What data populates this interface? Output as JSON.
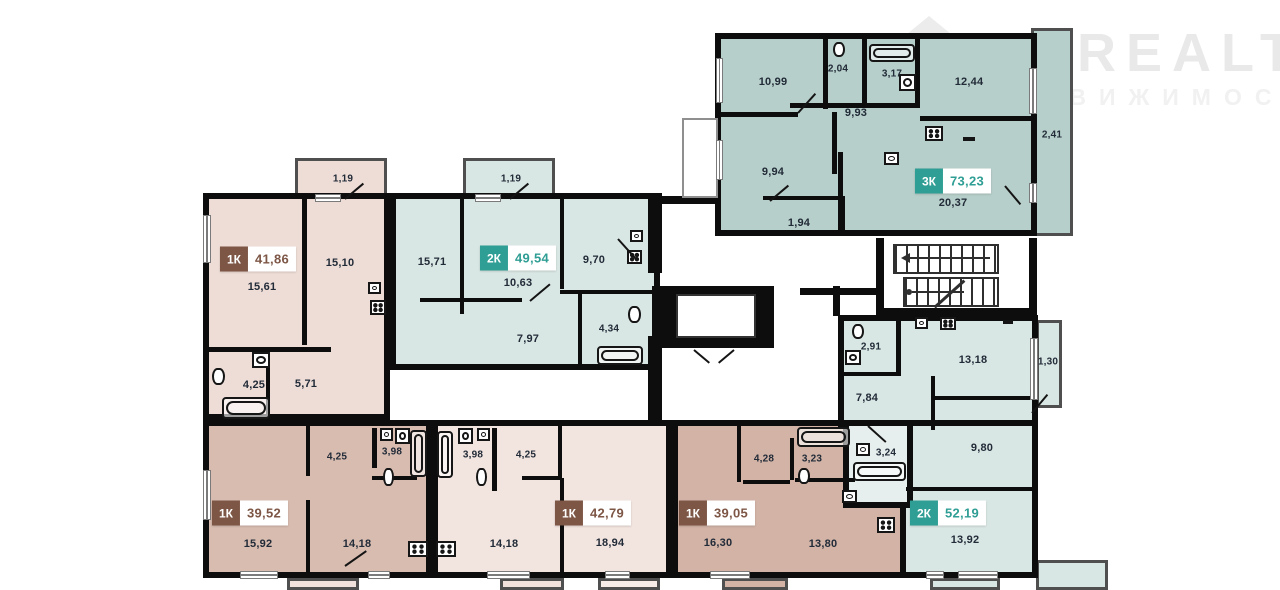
{
  "watermark": {
    "brand": "ONREALT",
    "subtitle": "НЕДВИЖИМОСТЬ"
  },
  "colors": {
    "wall": "#0d0d0d",
    "teal_badge": "#2f9e94",
    "brown_badge": "#7d5646",
    "room_teal_dark": "#b7cfca",
    "room_teal_light": "#d9e7e4",
    "room_pink": "#eeddd7",
    "room_pink_light": "#f2e4df",
    "room_tan": "#d8bcb0",
    "room_tan_dark": "#d2b3a6"
  },
  "apartments": [
    {
      "id": "3k-73",
      "type": "3К",
      "area": "73,23",
      "rooms": {
        "bedroom1": "10,99",
        "wc": "2,04",
        "bath": "3,17",
        "bedroom2": "12,44",
        "hall": "9,93",
        "bedroom3": "9,94",
        "balcony1": "1,94",
        "living_kitchen": "20,37",
        "balcony2": "2,41"
      }
    },
    {
      "id": "1k-41",
      "type": "1К",
      "area": "41,86",
      "rooms": {
        "living": "15,61",
        "kitchen": "15,10",
        "balcony": "1,19",
        "bath": "4,25",
        "hall": "5,71"
      }
    },
    {
      "id": "2k-49",
      "type": "2К",
      "area": "49,54",
      "rooms": {
        "bedroom": "15,71",
        "living": "10,63",
        "kitchen": "9,70",
        "hall": "7,97",
        "bath": "4,34",
        "balcony": "1,19"
      }
    },
    {
      "id": "2k-52",
      "type": "2К",
      "area": "52,19",
      "rooms": {
        "wc": "2,91",
        "kitchen": "13,18",
        "balcony": "1,30",
        "hall": "7,84",
        "bath": "3,24",
        "bedroom": "9,80",
        "living": "13,92"
      }
    },
    {
      "id": "1k-39a",
      "type": "1К",
      "area": "39,52",
      "rooms": {
        "living": "15,92",
        "hall": "4,25",
        "bath": "3,98",
        "kitchen": "14,18"
      }
    },
    {
      "id": "1k-42",
      "type": "1К",
      "area": "42,79",
      "rooms": {
        "bath": "3,98",
        "hall": "4,25",
        "kitchen": "14,18",
        "living": "18,94"
      }
    },
    {
      "id": "1k-39b",
      "type": "1К",
      "area": "39,05",
      "rooms": {
        "hall": "4,28",
        "bath": "3,23",
        "living": "16,30",
        "kitchen": "13,80"
      }
    }
  ]
}
